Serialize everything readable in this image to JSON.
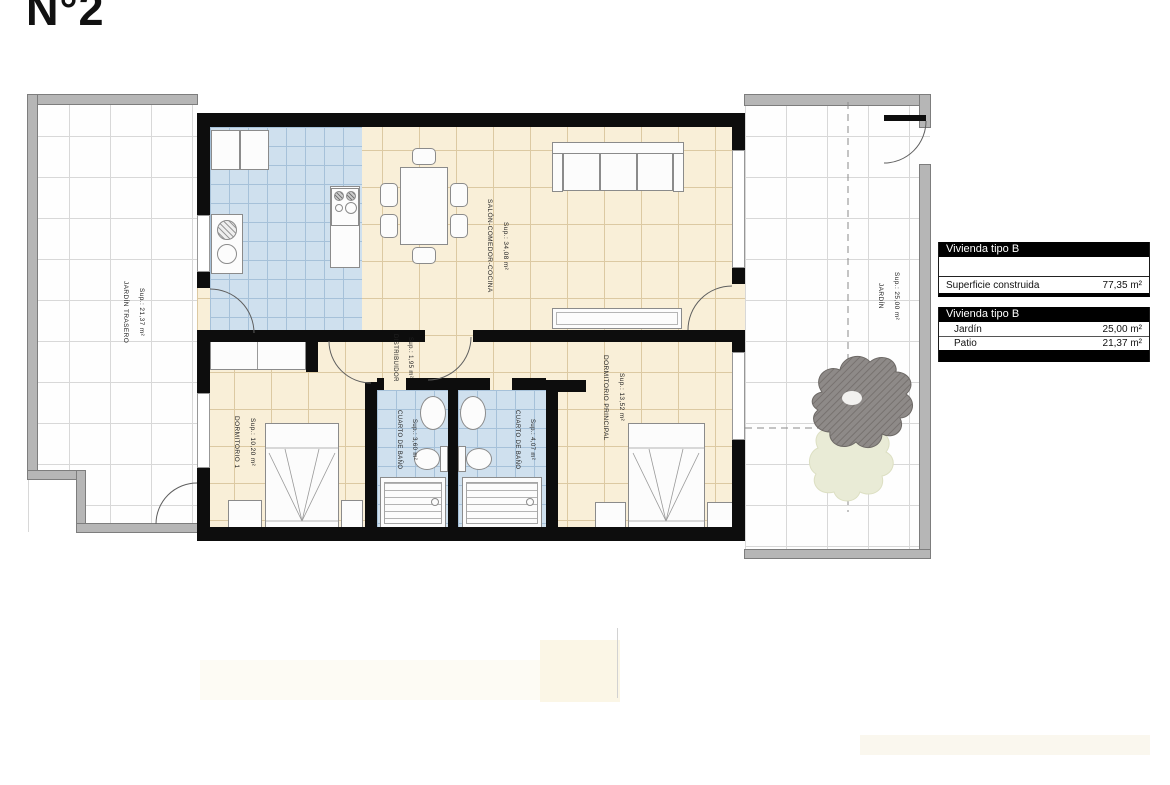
{
  "title": "N°2",
  "rooms": [
    {
      "name": "JARDÍN TRASERO",
      "sup": "Sup.: 21,37 m²"
    },
    {
      "name": "SALÓN-COMEDOR-COCINA",
      "sup": "Sup.: 34,08 m²"
    },
    {
      "name": "DISTRIBUIDOR",
      "sup": "Sup.: 1,95 m²"
    },
    {
      "name": "DORMITORIO 1",
      "sup": "Sup.: 10,20 m²"
    },
    {
      "name": "CUARTO DE BAÑO",
      "sup": "Sup.: 3,60 m²"
    },
    {
      "name": "CUARTO DE BAÑO",
      "sup": "Sup.: 4,07 m²"
    },
    {
      "name": "DORMITORIO PRINCIPAL",
      "sup": "Sup.: 13,52 m²"
    },
    {
      "name": "JARDÍN",
      "sup": "Sup.: 25,00 m²"
    }
  ],
  "legend": {
    "surface_table": {
      "header": "Vivienda tipo B",
      "rows": [
        {
          "label": "Superficie construida",
          "value": "77,35 m²"
        }
      ]
    },
    "exterior_table": {
      "header": "Vivienda tipo B",
      "rows": [
        {
          "label": "Jardín",
          "value": "25,00 m²"
        },
        {
          "label": "Patio",
          "value": "21,37 m²"
        }
      ]
    }
  },
  "colors": {
    "wall": "#0d0d0d",
    "garden_wall": "#b6b6b6",
    "floor_cream": "#f9efd8",
    "tile_blue": "#cfe0ee",
    "legend_header_bg": "#000000",
    "legend_header_text": "#ffffff"
  }
}
